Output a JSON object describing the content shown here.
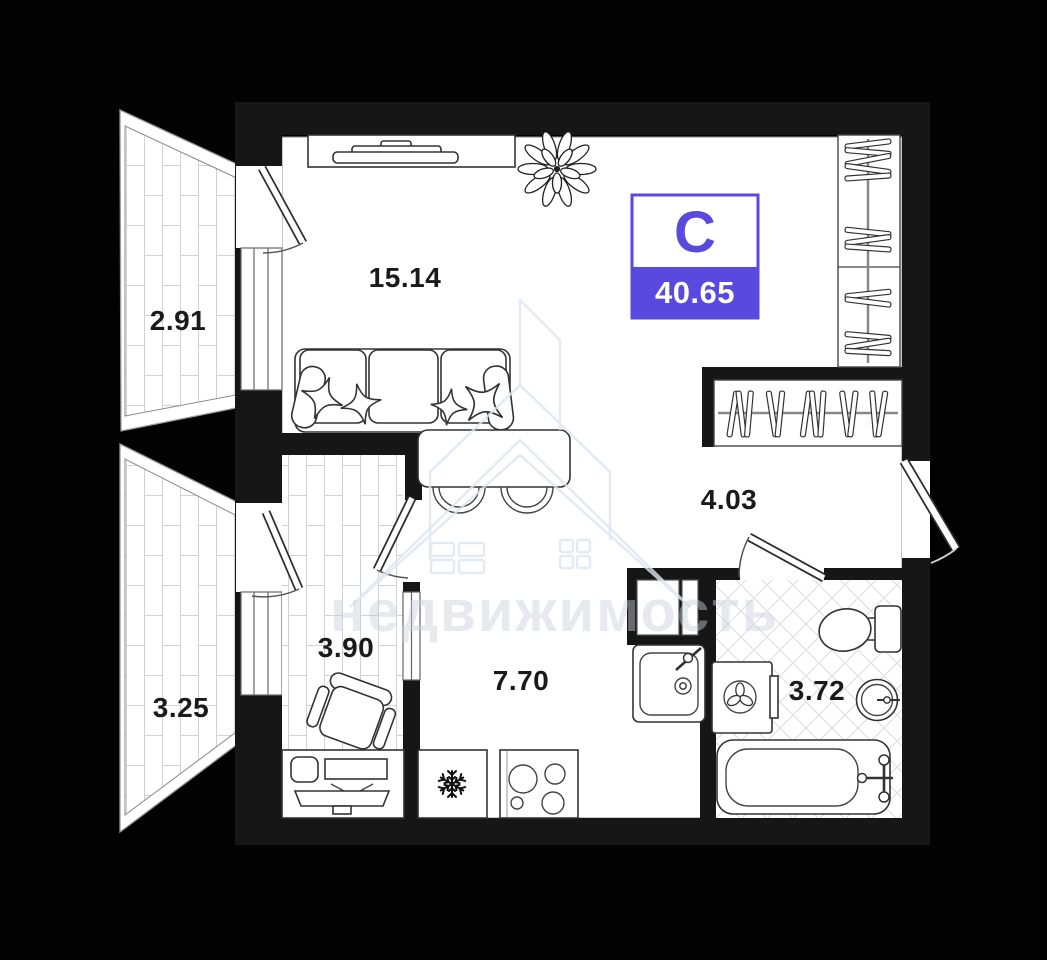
{
  "badge": {
    "letter": "С",
    "area": "40.65"
  },
  "rooms": {
    "balcony_top": "2.91",
    "living": "15.14",
    "balcony_bottom": "3.25",
    "office": "3.90",
    "kitchen": "7.70",
    "hall": "4.03",
    "bath": "3.72"
  },
  "watermark": "недвижимость",
  "colors": {
    "accent": "#5A49DF",
    "background": "#020202",
    "wall": "#161616",
    "label": "#1A1A1A",
    "watermark_tint": "#DCE6F1"
  },
  "icon_names": [
    "plant-icon",
    "sofa-icon",
    "tv-icon",
    "wardrobe-hangers-icon",
    "dining-table-icon",
    "desk-icon",
    "office-chair-icon",
    "fridge-snowflake-icon",
    "stove-burners-icon",
    "kitchen-sink-icon",
    "vent-shaft-icon",
    "toilet-icon",
    "washing-machine-icon",
    "round-sink-icon",
    "bathtub-icon",
    "door-swing-icon"
  ]
}
